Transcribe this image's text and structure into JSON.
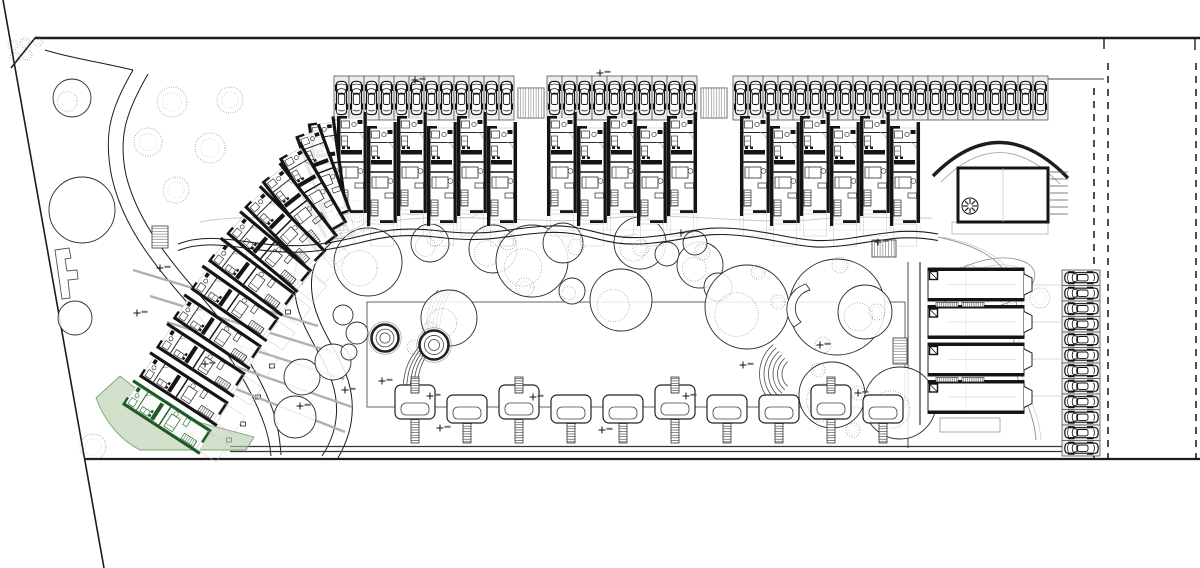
{
  "drawing": {
    "kind": "architectural-site-plan",
    "canvas": {
      "w": 1200,
      "h": 568,
      "background": "#ffffff"
    },
    "colors": {
      "ink": "#1c1c1c",
      "wall": "#141414",
      "mid": "#4a4a4a",
      "light": "#9a9a9a",
      "faint": "#c9c9c9",
      "stall_fill": "#ededed",
      "highlight_fill": "#b5cbaa",
      "highlight_stroke": "#7ba173",
      "highlight_wall": "#1d5c25"
    },
    "boundary": {
      "top_line": {
        "x1": 35,
        "y": 38,
        "x2": 1200
      },
      "top_ticks": [
        {
          "x": 1104,
          "y1": 38,
          "y2": 49
        },
        {
          "x": 1195,
          "y1": 38,
          "y2": 50
        }
      ],
      "corner_cut": {
        "x1": 35,
        "y1": 38,
        "x2": 11,
        "y2": 68
      },
      "left_slant": {
        "x1": 3,
        "y1": 0,
        "x2": 104,
        "y2": 568
      },
      "bottom_line": {
        "y": 459,
        "x1": 85,
        "x2": 1200
      },
      "dashed_lines": [
        {
          "x": 1094,
          "y1": 88,
          "y2": 459
        },
        {
          "x": 1108,
          "y1": 63,
          "y2": 459
        },
        {
          "x": 1196,
          "y1": 63,
          "y2": 459
        }
      ],
      "parking_top_edge": {
        "y": 79,
        "x1": 1048,
        "x2": 1104
      },
      "amenity_right_edge": {
        "x": 908,
        "y1": 262,
        "y2": 448
      }
    },
    "parking_top": {
      "stall_y": 76,
      "stall_w": 15,
      "stall_h": 44,
      "groups": [
        {
          "x": 334,
          "count": 12
        },
        {
          "x": 547,
          "count": 10
        },
        {
          "x": 733,
          "count": 21
        }
      ],
      "ramps": [
        {
          "x": 518,
          "y": 88,
          "w": 26,
          "h": 30
        },
        {
          "x": 701,
          "y": 88,
          "w": 26,
          "h": 30
        }
      ]
    },
    "parking_side": {
      "x": 1062,
      "y": 270,
      "stall_w": 38,
      "stall_h": 15.5,
      "count": 12
    },
    "units_top": {
      "y": 112,
      "bay_w": 30,
      "stagger": 10,
      "groups": [
        {
          "x": 337,
          "count": 6
        },
        {
          "x": 547,
          "count": 5
        },
        {
          "x": 740,
          "count": 6
        }
      ]
    },
    "units_wing": [
      {
        "x": 322,
        "y": 118,
        "rot": -8
      },
      {
        "x": 308,
        "y": 128,
        "rot": -20
      },
      {
        "x": 290,
        "y": 148,
        "rot": -30
      },
      {
        "x": 271,
        "y": 170,
        "rot": -38
      },
      {
        "x": 252,
        "y": 194,
        "rot": -45
      },
      {
        "x": 233,
        "y": 220,
        "rot": -50
      },
      {
        "x": 214,
        "y": 247,
        "rot": -53
      },
      {
        "x": 196,
        "y": 275,
        "rot": -55
      },
      {
        "x": 178,
        "y": 304,
        "rot": -56
      },
      {
        "x": 161,
        "y": 333,
        "rot": -57
      },
      {
        "x": 144,
        "y": 362,
        "rot": -57
      }
    ],
    "green_unit": {
      "x": 127,
      "y": 390,
      "rot": -57,
      "terrace": "M96,398 L120,376 L168,414 L254,437 L246,450 L140,450 C120,440 104,420 96,398 Z"
    },
    "clubhouse": {
      "rect": {
        "x": 958,
        "y": 168,
        "w": 90,
        "h": 54
      },
      "canopy": "M933,176 Q1000,108 1068,178",
      "canopy2": "M941,182 Q1000,122 1060,184",
      "fan": {
        "cx": 970,
        "cy": 206,
        "r": 8
      },
      "stairs_right": {
        "x": 1050,
        "y": 172,
        "w": 18,
        "count": 7,
        "step": 7
      },
      "base": {
        "x": 952,
        "y": 222,
        "w": 96,
        "h": 12
      },
      "path_s": "M938,237 C975,245 1005,258 1014,290 C1022,318 1008,342 1016,372 C1022,396 1034,412 1036,440"
    },
    "quad_building": {
      "x": 928,
      "y": 268,
      "unit_w": 96,
      "unit_h": 33,
      "gap": 4.5,
      "count": 4,
      "left_wall_x": 920,
      "link_lines_y": [
        285,
        322,
        359,
        396
      ],
      "link_x2": 1062,
      "base": {
        "x": 940,
        "y": 418,
        "w": 60,
        "h": 14
      }
    },
    "lawn": {
      "x": 367,
      "y": 302,
      "w": 538,
      "h": 105
    },
    "paths": {
      "promenade": "M178,244 C220,228 258,252 320,244 C368,238 380,224 440,231 C492,237 506,228 548,226 C590,224 602,241 648,237 C694,233 702,224 748,230 C794,236 806,245 852,238 C886,233 906,228 938,234",
      "terrace_wave": "M200,222 C260,210 330,228 400,220 C470,212 540,226 610,218 C680,211 750,226 820,219 C860,215 900,219 932,218",
      "road_left_a": "M133,70 C110,110 103,135 112,178 C122,222 148,258 185,300 C222,342 248,382 262,418 C268,433 270,444 271,456",
      "road_left_b": "M148,74 C126,112 118,137 126,175 C136,216 162,252 198,293 C234,334 259,373 272,408 C278,424 280,440 281,455",
      "road_right_a": "M318,233 C298,252 290,270 296,300 C302,332 322,352 332,382 C340,406 338,432 322,456",
      "road_right_b": "M332,242 C315,258 308,272 313,300 C319,330 338,350 348,380 C356,406 353,432 338,458",
      "corner_link": "M45,50 C70,58 100,62 133,70",
      "promenade_bottom": [
        {
          "y": 446.5,
          "x1": 230,
          "x2": 1062
        },
        {
          "y": 451.5,
          "x1": 230,
          "x2": 1062
        }
      ],
      "road_ticks": [
        [
          272,
          366
        ],
        [
          258,
          397
        ],
        [
          243,
          424
        ],
        [
          229,
          440
        ],
        [
          288,
          312
        ],
        [
          300,
          282
        ]
      ]
    },
    "gray_walls": [
      [
        133,
        270,
        318,
        326
      ],
      [
        150,
        296,
        332,
        352
      ],
      [
        167,
        322,
        344,
        379
      ],
      [
        185,
        349,
        352,
        407
      ],
      [
        203,
        376,
        345,
        432
      ]
    ],
    "stairs_hatch": [
      {
        "x": 518,
        "y": 88,
        "w": 26,
        "h": 30,
        "o": "v"
      },
      {
        "x": 701,
        "y": 88,
        "w": 26,
        "h": 30,
        "o": "v"
      },
      {
        "x": 152,
        "y": 226,
        "w": 16,
        "h": 22,
        "o": "h"
      },
      {
        "x": 872,
        "y": 240,
        "w": 24,
        "h": 17,
        "o": "v"
      },
      {
        "x": 893,
        "y": 338,
        "w": 14,
        "h": 26,
        "o": "h"
      }
    ],
    "stair_arcs": {
      "cx": 798,
      "cy": 374,
      "radii": [
        16,
        20.5,
        25,
        29.5,
        34,
        38.5
      ],
      "a1": 130,
      "a2": 230
    },
    "stair_curves": {
      "base": "M438,290 C420,315 432,330 415,352 C402,370 405,380 402,392",
      "count": 5,
      "dx": 3.5
    },
    "trees": [
      [
        72,
        98,
        19,
        1
      ],
      [
        82,
        210,
        33,
        0
      ],
      [
        75,
        318,
        17,
        0
      ],
      [
        302,
        377,
        18,
        0
      ],
      [
        295,
        417,
        21,
        0
      ],
      [
        333,
        362,
        18,
        0
      ],
      [
        343,
        315,
        10,
        0
      ],
      [
        357,
        333,
        11,
        0
      ],
      [
        349,
        352,
        8,
        0
      ],
      [
        368,
        262,
        34,
        1
      ],
      [
        430,
        243,
        19,
        1
      ],
      [
        449,
        318,
        28,
        1
      ],
      [
        493,
        249,
        24,
        1
      ],
      [
        532,
        261,
        36,
        1
      ],
      [
        563,
        243,
        20,
        0
      ],
      [
        572,
        291,
        13,
        1
      ],
      [
        621,
        300,
        31,
        1
      ],
      [
        640,
        243,
        26,
        1
      ],
      [
        667,
        254,
        12,
        0
      ],
      [
        700,
        265,
        23,
        1
      ],
      [
        718,
        287,
        14,
        0
      ],
      [
        695,
        243,
        12,
        0
      ],
      [
        747,
        307,
        42,
        1
      ],
      [
        837,
        307,
        48,
        0
      ],
      [
        865,
        312,
        27,
        1
      ],
      [
        832,
        395,
        33,
        1
      ],
      [
        900,
        403,
        36,
        1
      ]
    ],
    "bushes": [
      [
        13,
        45,
        5
      ],
      [
        25,
        43,
        5
      ],
      [
        38,
        41,
        5
      ],
      [
        15,
        57,
        5
      ],
      [
        27,
        55,
        5
      ],
      [
        172,
        102,
        15
      ],
      [
        230,
        100,
        13
      ],
      [
        148,
        142,
        14
      ],
      [
        210,
        148,
        15
      ],
      [
        176,
        190,
        13
      ],
      [
        93,
        447,
        13
      ],
      [
        332,
        226,
        12
      ],
      [
        357,
        211,
        11
      ],
      [
        968,
        278,
        13
      ],
      [
        1008,
        292,
        12
      ],
      [
        1040,
        298,
        10
      ],
      [
        435,
        238,
        8
      ],
      [
        508,
        242,
        8
      ],
      [
        576,
        247,
        8
      ],
      [
        641,
        248,
        8
      ],
      [
        702,
        252,
        8
      ],
      [
        758,
        272,
        7
      ],
      [
        778,
        302,
        7
      ],
      [
        840,
        265,
        8
      ],
      [
        877,
        312,
        8
      ],
      [
        823,
        345,
        8
      ],
      [
        818,
        370,
        7
      ],
      [
        858,
        393,
        7
      ],
      [
        820,
        415,
        7
      ],
      [
        853,
        430,
        7
      ],
      [
        430,
        330,
        8
      ],
      [
        414,
        347,
        7
      ],
      [
        525,
        287,
        9
      ]
    ],
    "ponds": [
      {
        "cx": 345,
        "cy": 220,
        "rx": 32,
        "ry": 17,
        "rot": -18
      },
      {
        "cx": 988,
        "cy": 284,
        "rx": 48,
        "ry": 24,
        "rot": -14
      }
    ],
    "mounds": [
      [
        278,
        188,
        16,
        8,
        -35
      ],
      [
        258,
        248,
        14,
        7,
        -40
      ],
      [
        300,
        160,
        11,
        6,
        -25
      ],
      [
        420,
        207,
        18,
        7,
        -12
      ],
      [
        466,
        212,
        14,
        6,
        -8
      ],
      [
        362,
        238,
        12,
        6,
        -20
      ],
      [
        240,
        312,
        13,
        7,
        -45
      ],
      [
        228,
        372,
        12,
        6,
        -50
      ]
    ],
    "spas": [
      {
        "cx": 385,
        "cy": 338,
        "r": 13.5
      },
      {
        "cx": 434,
        "cy": 345,
        "r": 14.5
      }
    ],
    "crescent": "M806,284 A26,26 0 0 0 794,327 L801,322 A19,19 0 0 1 810,290 Z",
    "pergolas": {
      "deck_y": 407,
      "ladder_bottom": 443,
      "xs": [
        415,
        467,
        519,
        571,
        623,
        675,
        727,
        779,
        831,
        883
      ],
      "styles": [
        "high",
        "low",
        "high",
        "low",
        "low",
        "high",
        "low",
        "low",
        "high",
        "low"
      ]
    },
    "f_building": "M55,250 L69,248 L71,258 L65,259 L67,271 L77,270 L78,279 L68,280 L70,298 L62,299 Z",
    "markers": [
      [
        415,
        80
      ],
      [
        600,
        73
      ],
      [
        878,
        242
      ],
      [
        820,
        345
      ],
      [
        858,
        393
      ],
      [
        743,
        365
      ],
      [
        686,
        396
      ],
      [
        602,
        430
      ],
      [
        533,
        397
      ],
      [
        440,
        428
      ],
      [
        430,
        396
      ],
      [
        382,
        381
      ],
      [
        345,
        390
      ],
      [
        300,
        406
      ],
      [
        205,
        364
      ],
      [
        160,
        268
      ],
      [
        137,
        313
      ],
      [
        681,
        233
      ]
    ]
  }
}
